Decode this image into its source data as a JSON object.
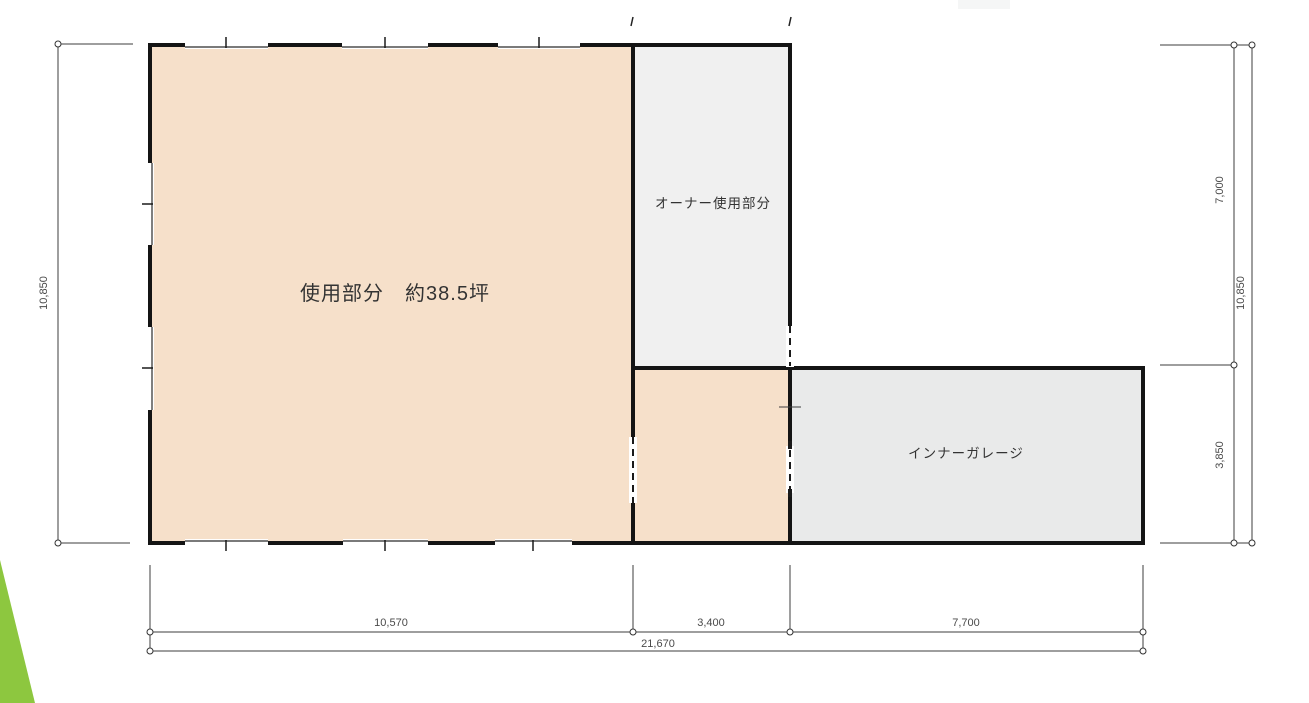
{
  "plan": {
    "type": "floor-plan",
    "rooms": {
      "main": {
        "label": "使用部分　約38.5坪"
      },
      "owner": {
        "label": "オーナー使用部分"
      },
      "garage": {
        "label": "インナーガレージ"
      }
    },
    "dimensions": {
      "left_total": "10,850",
      "right_upper": "7,000",
      "right_lower": "3,850",
      "right_total": "10,850",
      "bottom_seg1": "10,570",
      "bottom_seg2": "3,400",
      "bottom_seg3": "7,700",
      "bottom_total": "21,670"
    },
    "colors": {
      "room_main_fill": "#f6e0ca",
      "room_owner_fill": "#f0f0f0",
      "room_garage_fill": "#e9eaea",
      "wall": "#141414",
      "dimension_line": "#3d3d3d",
      "accent_green": "#8dc73f",
      "top_right_fragment": "#f5f6f6"
    }
  }
}
